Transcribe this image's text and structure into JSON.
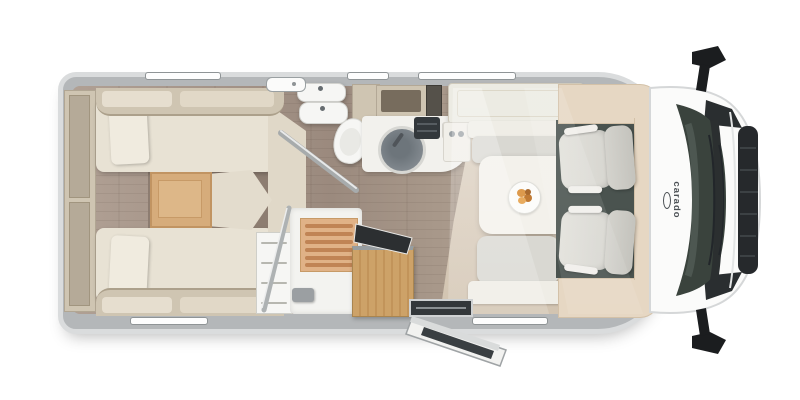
{
  "brand": {
    "logo_text": "carado"
  },
  "view": {
    "type": "motorhome-floorplan-top-view"
  },
  "features": [
    "rear-storage-shelves",
    "twin-single-bed-left",
    "twin-single-bed-right",
    "bed-pillows",
    "center-wood-step",
    "washbasin-double",
    "toilet",
    "bathroom-door-angled",
    "wardrobe-shelves",
    "shower-with-duckboard",
    "kitchen-sink-round",
    "hob",
    "overhead-lockers",
    "entry-wood-cabinet",
    "entry-door-open",
    "dinette-table",
    "plate-of-food",
    "bench-seat-front",
    "bench-seat-rear",
    "swivel-cab-seat-driver",
    "swivel-cab-seat-passenger",
    "dashboard",
    "windshield",
    "wipers",
    "front-grille",
    "side-mirror-left",
    "side-mirror-right",
    "wall-windows"
  ],
  "colors": {
    "shell_rim": "#dadcdd",
    "wall": "#b4b7b9",
    "floor_wood": "#a29185",
    "floor_wood_dark": "#8d7d71",
    "floor_beige": "#d7cbb9",
    "furniture_cream": "#e8e2d4",
    "furniture_tan": "#cfc5b2",
    "accent_step_wood": "#d6ac7b",
    "entry_wood": "#cda268",
    "fixture_white": "#f6f6f4",
    "sink_gray": "#81888e",
    "hob_dark": "#33383c",
    "seat_gray": "#d9d8d2",
    "cab_floor": "#4a534f",
    "dash_tan": "#e6d7c3",
    "windshield": "#3a433d",
    "grille_dark": "#26292c",
    "mirror_black": "#1b1d1f",
    "logo_text": "#4b5054",
    "food_orange": "#dd9a4c"
  }
}
